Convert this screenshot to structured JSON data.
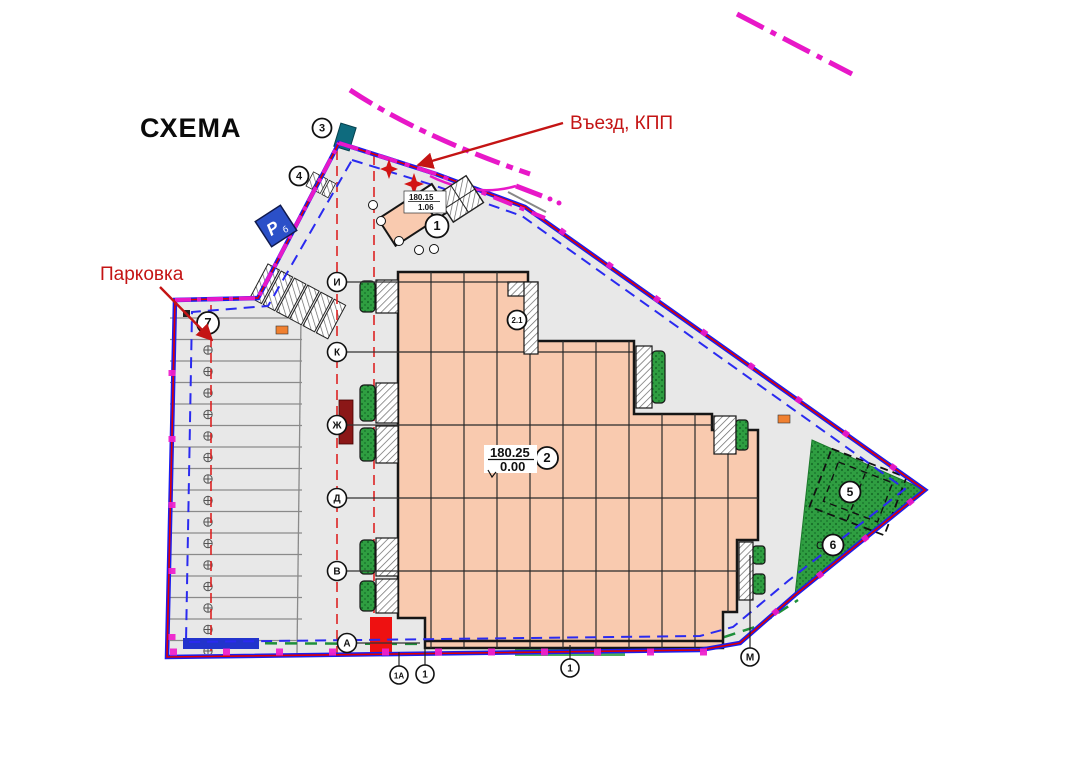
{
  "title": "СХЕМА",
  "labels": {
    "entrance": "Въезд, КПП",
    "parking": "Парковка",
    "main_building_elev_top": "180.25",
    "main_building_elev_bottom": "0.00",
    "kpp_elev_top": "180.15",
    "kpp_elev_bottom": "1.06",
    "parking_sign_letter": "P",
    "parking_sign_sub": "б",
    "c_axis_letter": "С"
  },
  "callouts": {
    "n1": "1",
    "n2": "2",
    "n2_1": "2.1",
    "n3": "3",
    "n4": "4",
    "n5": "5",
    "n6": "6",
    "n7": "7"
  },
  "axes_left": {
    "a1": "И",
    "a2": "К",
    "a3": "Ж",
    "a4": "Д",
    "a5": "В",
    "a6": "А"
  },
  "axes_bottom": {
    "b1": "1А",
    "b2": "1",
    "b3": "1",
    "b4": "М"
  },
  "colors": {
    "site_fill": "#e8e8e8",
    "building_fill": "#f9caaf",
    "boundary_blue": "#1c1cee",
    "boundary_red": "#e00000",
    "boundary_magenta": "#e818c8",
    "dashed_blue": "#2a2af0",
    "fire_lane_red": "#dd2222",
    "green_area": "#2f9e41",
    "annotation_red": "#c41414",
    "parking_sign_blue": "#2b50c8",
    "teal_block": "#0e6b7e",
    "dark_red_block": "#8b1717",
    "bright_red_block": "#ee1111",
    "blue_block": "#2233cc",
    "orange_marker": "#f08030"
  }
}
